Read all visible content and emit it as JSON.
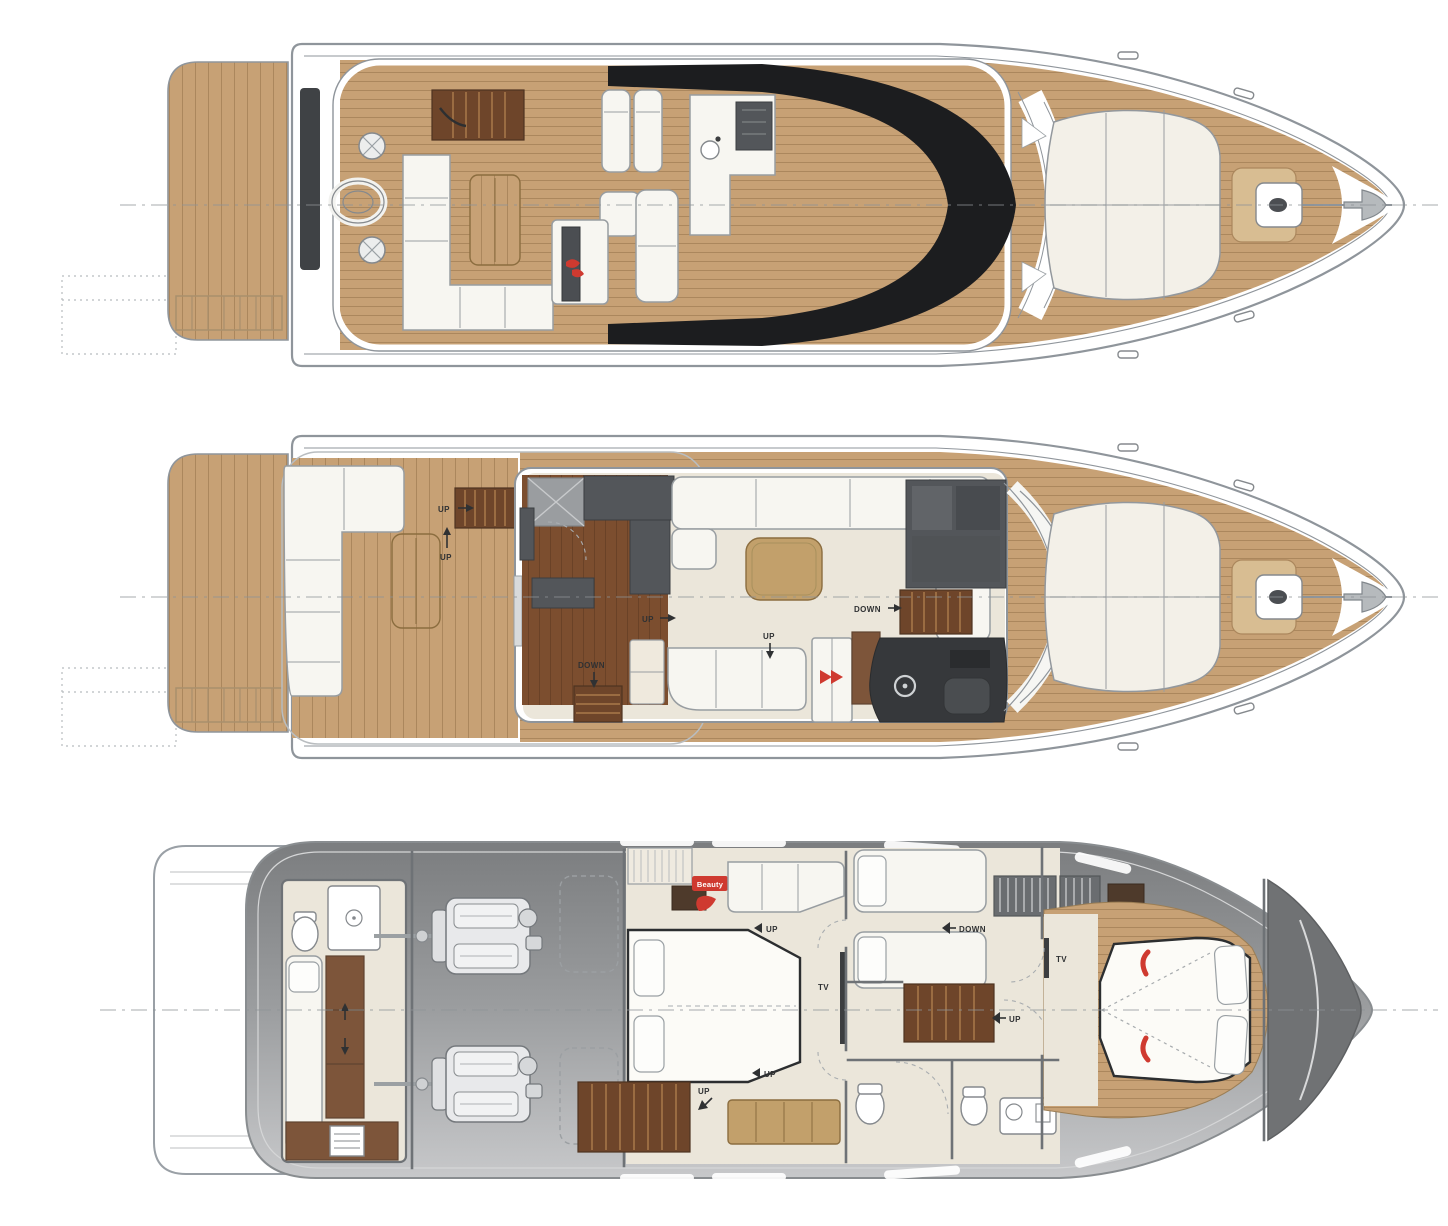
{
  "labels": {
    "up": "UP",
    "down": "DOWN",
    "tv": "TV",
    "beauty": "Beauty"
  },
  "colors": {
    "teak": "#c7a175",
    "teak_seam": "#ab875d",
    "teak_pale": "#d8bd92",
    "wood_dark": "#7c4e2f",
    "wood_seam": "#6a4227",
    "stair": "#6e452a",
    "stair_tread": "#9a6c42",
    "cream": "#ebe6da",
    "furn_white": "#f7f6f1",
    "furn_line": "#989da1",
    "gray_furn": "#53565a",
    "charcoal": "#36383b",
    "glass_black": "#1c1d1f",
    "hull_line": "#8f959b",
    "hull_gray_top": "#7b7d7f",
    "hull_gray_mid": "#9a9c9e",
    "hull_gray_bottom": "#c7c8ca",
    "red_accent": "#cf3a30",
    "label": "#2f3133",
    "tan": "#c2a06b",
    "brown_cab": "#7d553a",
    "dark_wood": "#4e3a2b",
    "berth_brown": "#8a5d3b"
  }
}
